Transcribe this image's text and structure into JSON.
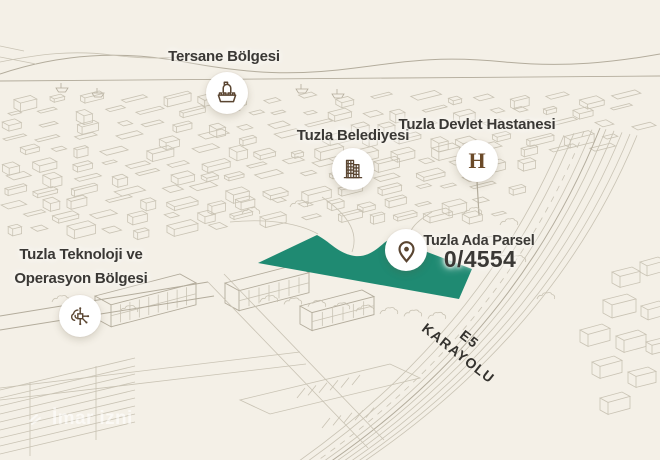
{
  "theme": {
    "background": "#f4f0e7",
    "line_color": "#c9c3b4",
    "parcel_fill": "#1f8a72",
    "icon_color": "#5a4531",
    "label_color": "#3a3835"
  },
  "markers": {
    "tersane": {
      "label": "Tersane Bölgesi",
      "icon": "ship-icon"
    },
    "belediye": {
      "label": "Tuzla Belediyesi",
      "icon": "municipality-building-icon"
    },
    "hastane": {
      "label": "Tuzla Devlet Hastanesi",
      "icon": "hospital-h-icon",
      "glyph": "H"
    },
    "teknoloji": {
      "label_line1": "Tuzla Teknoloji ve",
      "label_line2": "Operasyon Bölgesi",
      "icon": "tech-circuit-icon"
    },
    "parsel": {
      "label": "Tuzla Ada Parsel",
      "value": "0/4554",
      "icon": "location-pin-icon"
    }
  },
  "road_label": {
    "line1": "E5",
    "line2": "KARAYOLU"
  },
  "watermark": {
    "text": "İmar izni"
  }
}
